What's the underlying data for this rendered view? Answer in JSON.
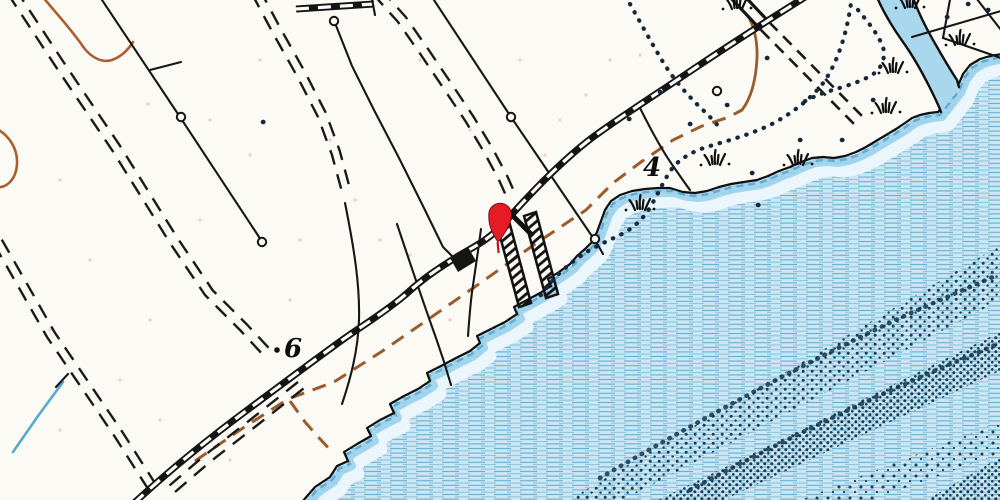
{
  "map": {
    "title": "coastal-topographic-map-detail",
    "labels": {
      "spot4": {
        "text": "4",
        "x": 643,
        "y": 176
      },
      "spot6": {
        "text": "6",
        "x": 284,
        "y": 357
      }
    },
    "marker": {
      "name": "red-location-pin",
      "x": 500,
      "y": 214,
      "color": "#e51c25"
    },
    "colors": {
      "paper": "#fcfaf4",
      "water_fill": "#cbe7f3",
      "water_line": "#6aaed0",
      "shore_band": "#9ed3ec",
      "stream_fill": "#a9d8ee",
      "stipple": "#1d3b52",
      "contour_brown": "#a8602f",
      "trail_brown": "#9a5c2d",
      "ink": "#161616",
      "pin_red": "#e51c25"
    },
    "paths": {
      "shoreline": "M302 502 L315 487 L330 477 L337 466 L348 461 L344 452 L357 444 L371 436 L367 428 L380 420 L394 413 L390 404 L404 396 L418 389 L430 381 L427 373 L441 366 L456 358 L470 351 L480 343 L477 336 L491 329 L505 322 L517 314 L514 307 L527 300 L540 293 L551 286 L548 279 L559 272 L570 264 L577 256 L585 249 L592 242 L597 232 L601 221 L605 210 L611 201 L620 195 L632 191 L645 189 L658 188 L670 188 L683 192 L695 193 L707 191 L719 187 L731 184 L744 182 L757 180 L768 176 L779 171 L790 167 L801 162 L812 158 L823 157 L834 158 L845 156 L856 152 L866 147 L876 141 L886 135 L896 129 L905 123 L912 118 L920 115 L929 113 L938 112 L957 88 L963 74 L970 65 L980 59 L990 56 L1002 54",
      "water": "M302 502 L315 487 L330 477 L337 466 L348 461 L344 452 L357 444 L371 436 L367 428 L380 420 L394 413 L390 404 L404 396 L418 389 L430 381 L427 373 L441 366 L456 358 L470 351 L480 343 L477 336 L491 329 L505 322 L517 314 L514 307 L527 300 L540 293 L551 286 L548 279 L559 272 L570 264 L577 256 L585 249 L592 242 L597 232 L601 221 L605 210 L611 201 L620 195 L632 191 L645 189 L658 188 L670 188 L683 192 L695 193 L707 191 L719 187 L731 184 L744 182 L757 180 L768 176 L779 171 L790 167 L801 162 L812 158 L823 157 L834 158 L845 156 L856 152 L866 147 L876 141 L886 135 L896 129 L905 123 L912 118 L920 115 L929 113 L938 112 L957 88 L963 74 L970 65 L980 59 L990 56 L1002 54 L1004 504 L298 504 Z",
      "railroad": "M810 -6 C762 24 722 50 695 68 C658 93 628 112 600 132 C570 153 537 186 505 222 C488 241 473 247 460 255 C432 272 418 283 405 295 C385 312 362 326 345 338 C313 361 281 385 250 408 C212 436 172 468 133 504",
      "railroad_stub": "M296 9 L374 4",
      "stub_tick": "M371 -6 L375 15",
      "stream_fill": "M876 -5 C884 14 893 28 903 42 C913 56 922 72 930 88 C935 98 939 106 941 112 L959 87 C949 68 941 54 933 40 C925 26 918 12 912 -5 Z",
      "stream_left_bank": "M876 -5 C884 14 893 28 903 42 C913 56 922 72 930 88 C935 98 939 106 941 112",
      "stream_right_bank": "M912 -5 C918 12 925 26 933 40 C941 54 949 68 957 80 L959 87",
      "contour_a": "M42 -4 C55 12 72 30 84 48 C92 58 102 63 112 60 C121 57 128 50 133 42",
      "contour_b": "M-5 128 C8 134 18 148 17 164 C16 180 6 189 -5 187",
      "trail": "M195 461 L243 428 L288 399 L334 382 L381 352 L433 316 L486 279 L538 242 L586 210 L613 183 L641 162 L673 140 L702 126 L729 117 L742 110",
      "trail_fork": "M290 401 L305 422 L321 440 L334 454",
      "trail_hook": "M742 110 C752 97 756 78 757 58 C757.5 44 755 29 750 20",
      "road1": "M8 -6 L58 70 L112 150 L170 243 L205 295 L240 330 L266 358",
      "road1b": "M298 382 L250 420 L205 455 L162 492",
      "road2": "M-6 244 L47 337 L115 437 L150 492",
      "road3": "M373 -6 L398 22 L421 55 L446 92 L466 122 L484 152 L499 180 L508 200",
      "road4": "M252 -6 L274 35 L297 76 L318 117 L332 155 L342 192",
      "crossing_a": "M727 -6 L761 30",
      "crossing_b": "M735 -14 L769 22",
      "crossing_dash_a": "M761 30 L858 128",
      "crossing_dash_b": "M769 22 L866 120",
      "fence1": "M98 -6 L180 117 L263 243",
      "fence1_spur": "M150 70 L181 62",
      "fence2": "M335 23 L352 66 L374 110 L399 158 L422 204 L443 247 L460 264",
      "telegraph": "M430 -6 L511 117 L562 192 L598 245 L603 254",
      "perp1": "M345 203 C354 248 360 285 359 320 C358 352 350 380 342 404",
      "perp2": "M397 224 C410 263 423 302 436 338 C442 355 447 371 451 385",
      "perp3": "M481 229 C478 252 475 272 472 292 C470 308 469 322 468 336",
      "fence3": "M640 108 C650 128 660 147 671 163 C678 173 684 182 690 190",
      "fence_ne1": "M951 -6 L943 38",
      "fence_ne2": "M943 38 L1001 58",
      "fence_ne3": "M912 37 L1001 11",
      "fence_ne4": "M973 -6 L1001 30",
      "dots1": "M630 4 C640 22 650 40 660 57 C672 78 688 96 705 112 C712 119 717 124 721 130",
      "dots2": "M852 -4 C848 28 840 58 824 82 C810 100 792 113 772 124 C752 134 730 140 710 146 C696 150 684 156 674 166 C666 176 660 190 652 204 C645 217 635 227 622 234 C610 240 596 246 585 253 C574 260 562 270 553 280 C547 287 543 292 540 296",
      "dots3": "M858 10 C868 22 878 34 883 47 C886 58 882 68 872 75 C860 82 846 86 833 90 C822 93 810 98 800 104",
      "dots_scatter": "M752 173h.3M842 140h.3M767 58h.3M727 105h.3M690 124h.3M660 92h.3M800 140h.3M758 205h.3M873 100h.3M968 4h.3M988 10h.3M947 17h.3M263 122h.3M629 119h.3",
      "trestle_a": "M497 225 L509 221 L531 303 L519 307 Z",
      "trestle_b": "M524 216 L536 212 L558 294 L546 298 Z",
      "trestle_knot": "M505 208 L533 236",
      "building": "M450 258 L468 247 L476 261 L458 272 Z",
      "stipple_band1": "M560 505 L1004 243 L1004 298 L614 505 Z",
      "stipple_band2": "M648 505 L1004 330 L1004 369 L713 505 Z",
      "stipple_band3": "M788 505 L1004 420 L1004 452 L858 505 Z",
      "stipple_band4": "M918 505 L1004 455 L1004 505 Z",
      "arc1": "M600 478 C700 420 800 365 900 318 C935 302 968 288 995 276",
      "arc2": "M690 490 C780 442 870 398 960 360 C975 354 988 348 1000 343",
      "pin": "M498 242 C490.5 231 488.6 223.5 488.8 214.5 A11.3 11.3 0 1 1 511.4 214.5 C511.6 223.5 506 231 501 238.5 C499.6 240.5 498.8 241.4 498 242 Z",
      "pin_stem": "M497.6 242 L498.6 253",
      "creek_sw": "M63 382 L38 416 L13 452",
      "creek_sw_tick": "M68 374 L56 387"
    },
    "tufts": [
      [
        737,
        8
      ],
      [
        910,
        7
      ],
      [
        960,
        44
      ],
      [
        893,
        72
      ],
      [
        886,
        112
      ],
      [
        715,
        164
      ],
      [
        798,
        164
      ],
      [
        640,
        209
      ]
    ],
    "circles": [
      [
        181,
        117
      ],
      [
        262,
        242
      ],
      [
        334,
        21
      ],
      [
        511,
        117
      ],
      [
        595,
        239
      ],
      [
        717,
        91
      ]
    ],
    "speckles": [
      [
        60,
        180
      ],
      [
        150,
        320
      ],
      [
        90,
        260
      ],
      [
        210,
        120
      ],
      [
        260,
        60
      ],
      [
        330,
        140
      ],
      [
        420,
        60
      ],
      [
        470,
        130
      ],
      [
        380,
        240
      ],
      [
        160,
        420
      ],
      [
        60,
        430
      ],
      [
        230,
        460
      ],
      [
        300,
        240
      ],
      [
        520,
        60
      ],
      [
        560,
        120
      ],
      [
        610,
        60
      ],
      [
        450,
        320
      ],
      [
        250,
        155
      ],
      [
        148,
        104
      ],
      [
        355,
        200
      ],
      [
        50,
        330
      ],
      [
        120,
        380
      ],
      [
        545,
        155
      ],
      [
        586,
        95
      ],
      [
        640,
        55
      ],
      [
        200,
        220
      ],
      [
        290,
        300
      ],
      [
        410,
        255
      ]
    ]
  }
}
